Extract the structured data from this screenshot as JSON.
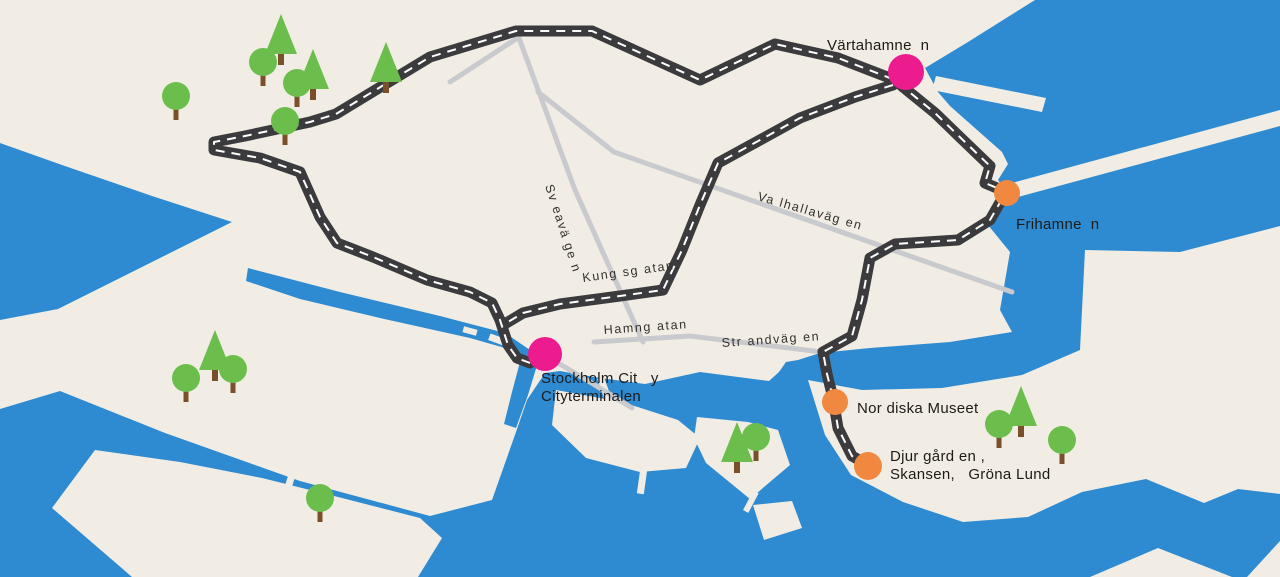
{
  "canvas": {
    "width": 1280,
    "height": 577
  },
  "colors": {
    "land": "#F1EDE4",
    "water": "#2E8BD1",
    "road": "#3B3B3D",
    "road-dash": "#FFFFFF",
    "street": "#C9CACE",
    "stop-pink": "#EC1C8E",
    "stop-orange": "#F0893F",
    "tree-green": "#6CBE4C",
    "tree-trunk": "#7A4F2B",
    "label-text": "#1E1B19"
  },
  "stops": [
    {
      "name": "vartahamnen",
      "label": "Värtahamne  n",
      "type": "pink",
      "x": 906,
      "y": 72,
      "r": 18,
      "label_x": 827,
      "label_y": 50
    },
    {
      "name": "frihamnen",
      "label": "Frihamne  n",
      "type": "orange",
      "x": 1007,
      "y": 193,
      "r": 13,
      "label_x": 1016,
      "label_y": 229
    },
    {
      "name": "stockholm-city-cityterminalen",
      "label": "Stockholm Cit   y\nCityterminalen",
      "type": "pink",
      "x": 545,
      "y": 354,
      "r": 17,
      "label_x": 541,
      "label_y": 383
    },
    {
      "name": "nordiska-museet",
      "label": "Nor diska Museet",
      "type": "orange",
      "x": 835,
      "y": 402,
      "r": 13,
      "label_x": 857,
      "label_y": 413
    },
    {
      "name": "djurgarden-skansen-grona-lund",
      "label": "Djur gård en ,\nSkansen,   Gröna Lund",
      "type": "orange",
      "x": 868,
      "y": 466,
      "r": 14,
      "label_x": 890,
      "label_y": 461
    }
  ],
  "street_labels": [
    {
      "name": "sveavagen",
      "label": "Sv eavä ge n",
      "x": 545,
      "y": 186,
      "rotate": 72
    },
    {
      "name": "kungsgatan",
      "label": "Kung sg atan",
      "x": 583,
      "y": 282,
      "rotate": -8
    },
    {
      "name": "hamngatan",
      "label": "Hamng atan",
      "x": 604,
      "y": 334,
      "rotate": -4
    },
    {
      "name": "valhallavagen",
      "label": "Va lhallaväg en",
      "x": 757,
      "y": 200,
      "rotate": 16
    },
    {
      "name": "strandvagen",
      "label": "Str andväg en",
      "x": 722,
      "y": 347,
      "rotate": -4
    }
  ],
  "trees": {
    "round": [
      [
        176,
        96
      ],
      [
        263,
        62
      ],
      [
        297,
        83
      ],
      [
        285,
        121
      ],
      [
        186,
        378
      ],
      [
        233,
        369
      ],
      [
        320,
        498
      ],
      [
        756,
        437
      ],
      [
        999,
        424
      ],
      [
        1062,
        440
      ]
    ],
    "pine": [
      [
        281,
        40
      ],
      [
        313,
        75
      ],
      [
        386,
        68
      ],
      [
        215,
        356
      ],
      [
        737,
        448
      ],
      [
        1021,
        412
      ]
    ]
  },
  "icons": {
    "round_tree": "green circle crown with brown trunk",
    "pine_tree": "green triangle conifer with brown trunk",
    "stop_marker": "filled colored circle"
  }
}
